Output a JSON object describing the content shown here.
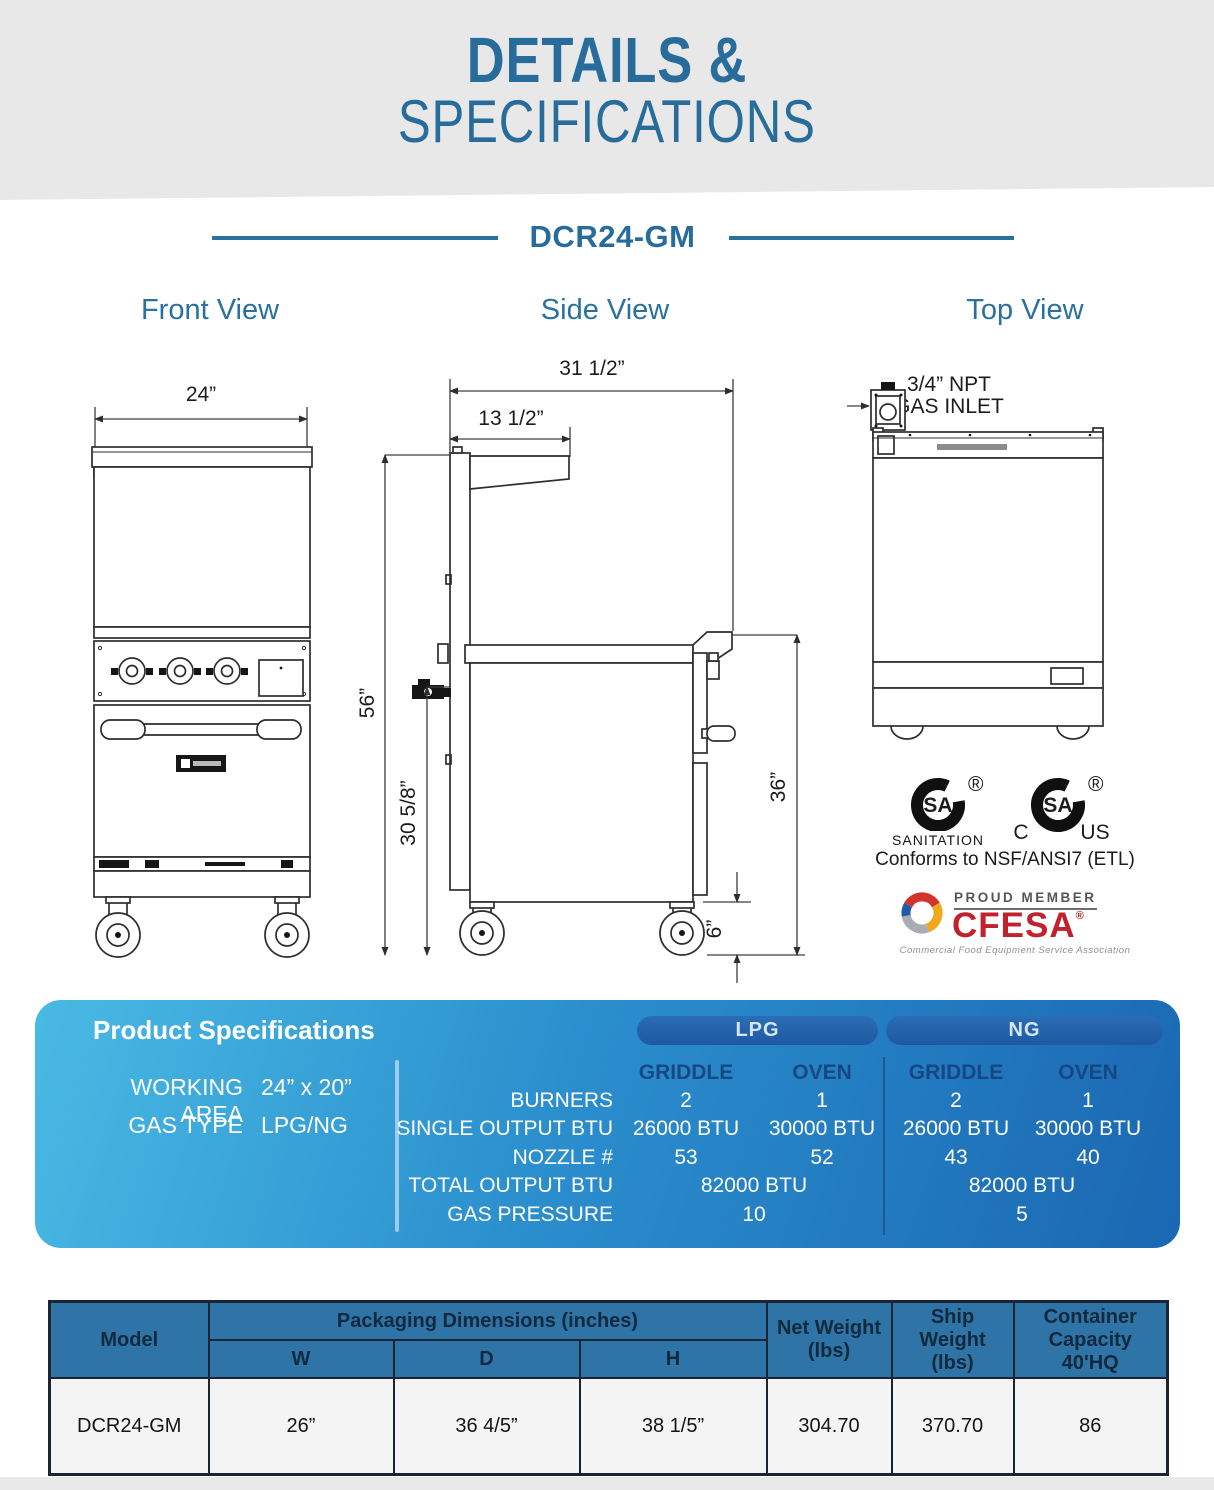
{
  "header": {
    "line1": "DETAILS &",
    "line2": "SPECIFICATIONS"
  },
  "model": {
    "name": "DCR24-GM"
  },
  "views": {
    "front": "Front View",
    "side": "Side View",
    "top": "Top View"
  },
  "front_view": {
    "width_dim": "24”"
  },
  "side_view": {
    "depth_dim": "31 1/2”",
    "shelf_dim": "13 1/2”",
    "height_dim": "56”",
    "body_height_dim": "30 5/8”",
    "work_height_dim": "36”",
    "caster_dim": "6”"
  },
  "top_view": {
    "gas_inlet_line1": "3/4” NPT",
    "gas_inlet_line2": "GAS INLET"
  },
  "certifications": {
    "csa1_text": "SA",
    "csa1_reg": "®",
    "csa1_label": "SANITATION",
    "csa2_text": "SA",
    "csa2_reg": "®",
    "csa2_left": "C",
    "csa2_right": "US",
    "conforms": "Conforms to NSF/ANSI7 (ETL)",
    "cfesa_member": "PROUD MEMBER",
    "cfesa_name": "CFESA",
    "cfesa_reg": "®",
    "cfesa_tagline": "Commercial Food Equipment Service Association"
  },
  "spec_panel": {
    "title": "Product Specifications",
    "working_area_label": "WORKING AREA",
    "working_area_value": "24” x 20”",
    "gas_type_label": "GAS TYPE",
    "gas_type_value": "LPG/NG",
    "row_labels": [
      "BURNERS",
      "SINGLE OUTPUT BTU",
      "NOZZLE #",
      "TOTAL OUTPUT BTU",
      "GAS PRESSURE"
    ],
    "groups": [
      {
        "name": "LPG",
        "cols": [
          "GRIDDLE",
          "OVEN"
        ],
        "burners": [
          "2",
          "1"
        ],
        "single_output_btu": [
          "26000 BTU",
          "30000 BTU"
        ],
        "nozzle": [
          "53",
          "52"
        ],
        "total_output_btu": "82000 BTU",
        "gas_pressure": "10"
      },
      {
        "name": "NG",
        "cols": [
          "GRIDDLE",
          "OVEN"
        ],
        "burners": [
          "2",
          "1"
        ],
        "single_output_btu": [
          "26000 BTU",
          "30000 BTU"
        ],
        "nozzle": [
          "43",
          "40"
        ],
        "total_output_btu": "82000 BTU",
        "gas_pressure": "5"
      }
    ]
  },
  "packaging_table": {
    "model_header": "Model",
    "packaging_header": "Packaging Dimensions (inches)",
    "w": "W",
    "d": "D",
    "h": "H",
    "net_weight_header": "Net Weight\n(lbs)",
    "ship_weight_header": "Ship Weight\n(lbs)",
    "container_header": "Container Capacity\n40'HQ",
    "row": {
      "model": "DCR24-GM",
      "w": "26”",
      "d": "36 4/5”",
      "h": "38 1/5”",
      "net_weight": "304.70",
      "ship_weight": "370.70",
      "container_capacity": "86"
    }
  },
  "colors": {
    "accent_blue": "#2a719e",
    "panel_gradient_start": "#49bae4",
    "panel_gradient_end": "#1a67b2",
    "pill_blue": "#2263ad",
    "table_header_blue": "#2e74a6",
    "cfesa_red": "#c2222e"
  }
}
